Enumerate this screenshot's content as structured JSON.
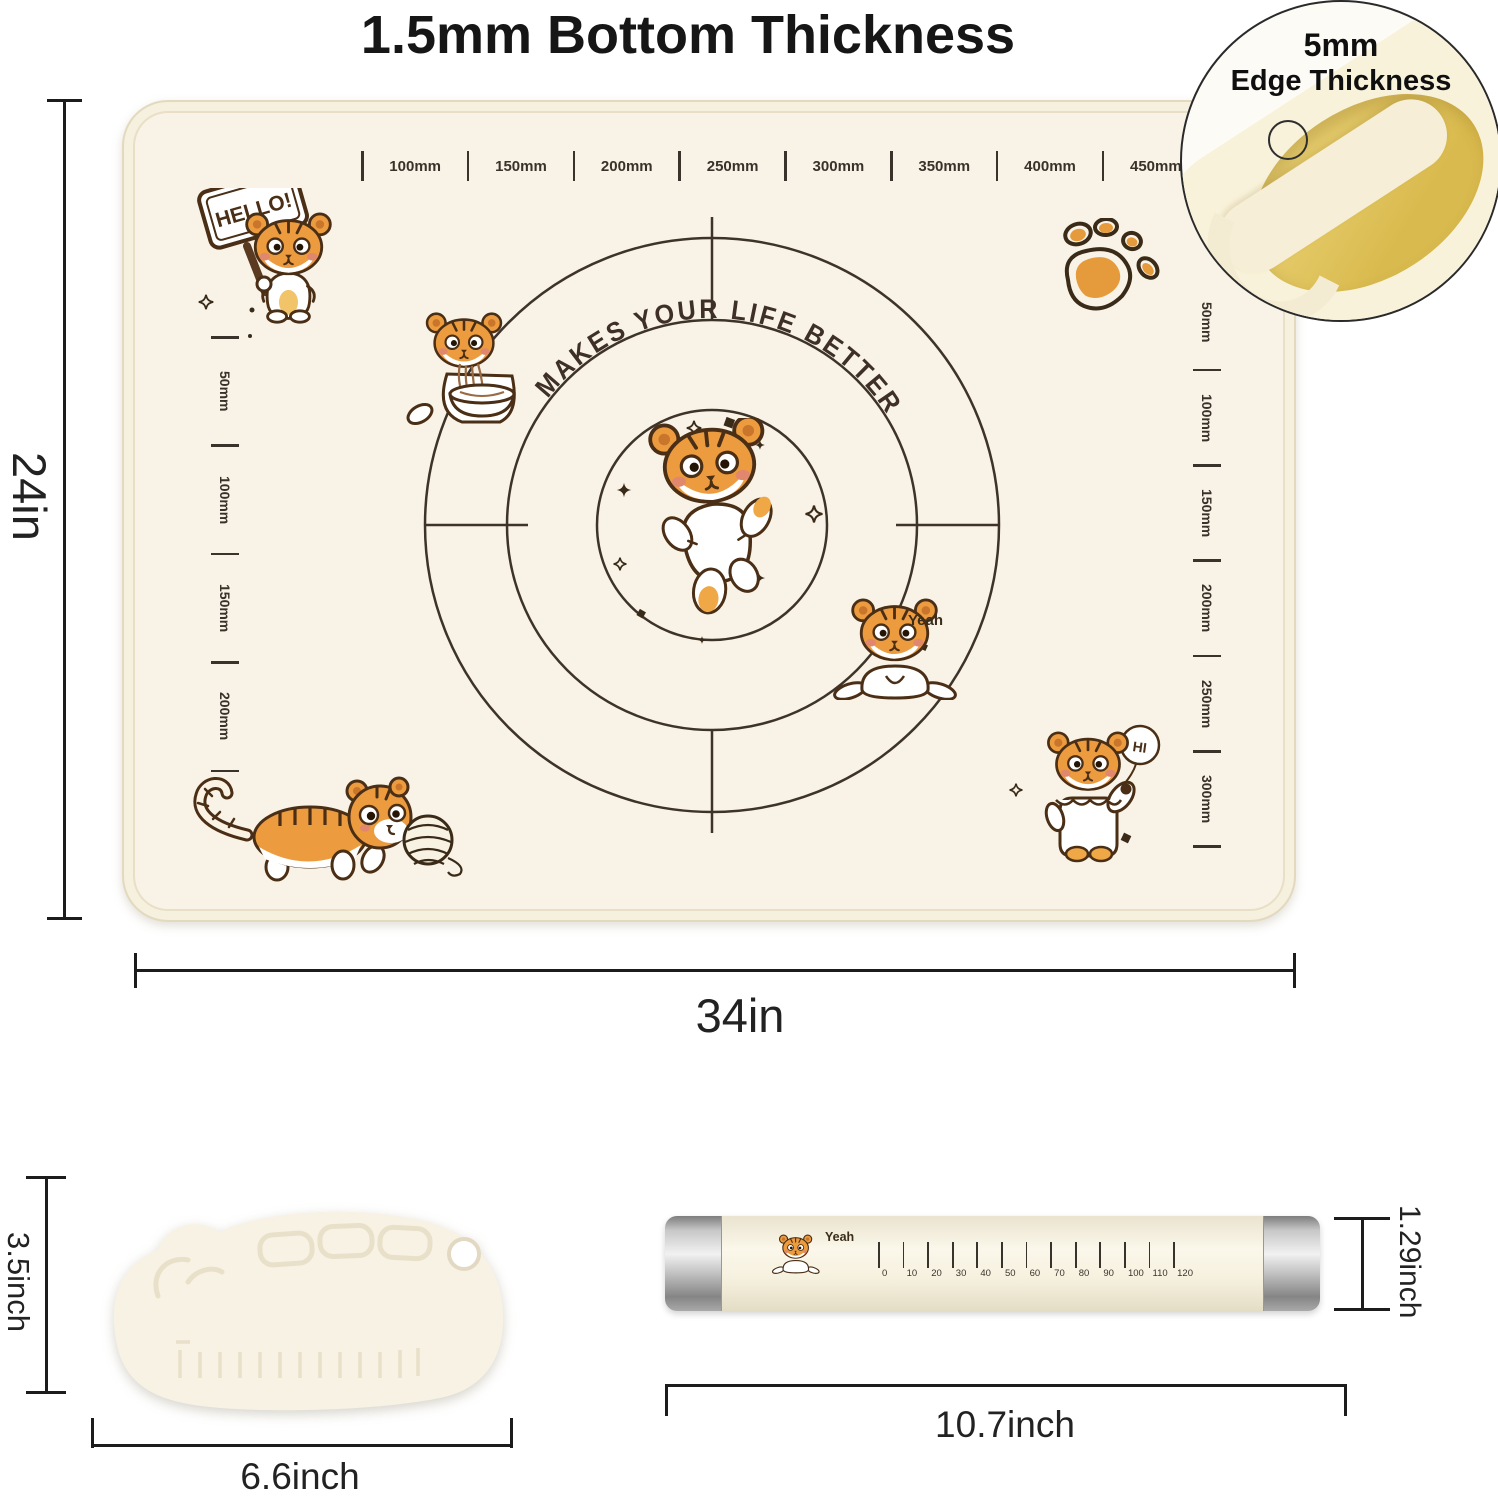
{
  "title": "1.5mm Bottom Thickness",
  "inset": {
    "line1": "5mm",
    "line2": "Edge Thickness"
  },
  "mat": {
    "arc_text": "MAKES  YOUR  LIFE  BETTER",
    "top_ruler": [
      "100mm",
      "150mm",
      "200mm",
      "250mm",
      "300mm",
      "350mm",
      "400mm",
      "450mm"
    ],
    "left_ruler": [
      "50mm",
      "100mm",
      "150mm",
      "200mm"
    ],
    "right_ruler": [
      "50mm",
      "100mm",
      "150mm",
      "200mm",
      "250mm",
      "300mm"
    ],
    "stickers": {
      "hello": "HELLO!",
      "yeah": "Yeah",
      "hi": "HI"
    }
  },
  "dimensions": {
    "mat_height": "24in",
    "mat_width": "34in",
    "scraper_height": "3.5inch",
    "scraper_width": "6.6inch",
    "pin_length": "10.7inch",
    "pin_diameter": "1.29inch"
  },
  "rolling_pin": {
    "sticker": "Yeah",
    "ruler": [
      "0",
      "10",
      "20",
      "30",
      "40",
      "50",
      "60",
      "70",
      "80",
      "90",
      "100",
      "110",
      "120"
    ]
  },
  "colors": {
    "mat_surface": "#f8f3e6",
    "mat_edge": "#f3ecd8",
    "print_brown": "#3e3329",
    "tiger_orange": "#ec9c3e",
    "tiger_outline": "#4a2e15",
    "inset_gold": "#ddc15c",
    "dimension_black": "#1c1c1c"
  }
}
